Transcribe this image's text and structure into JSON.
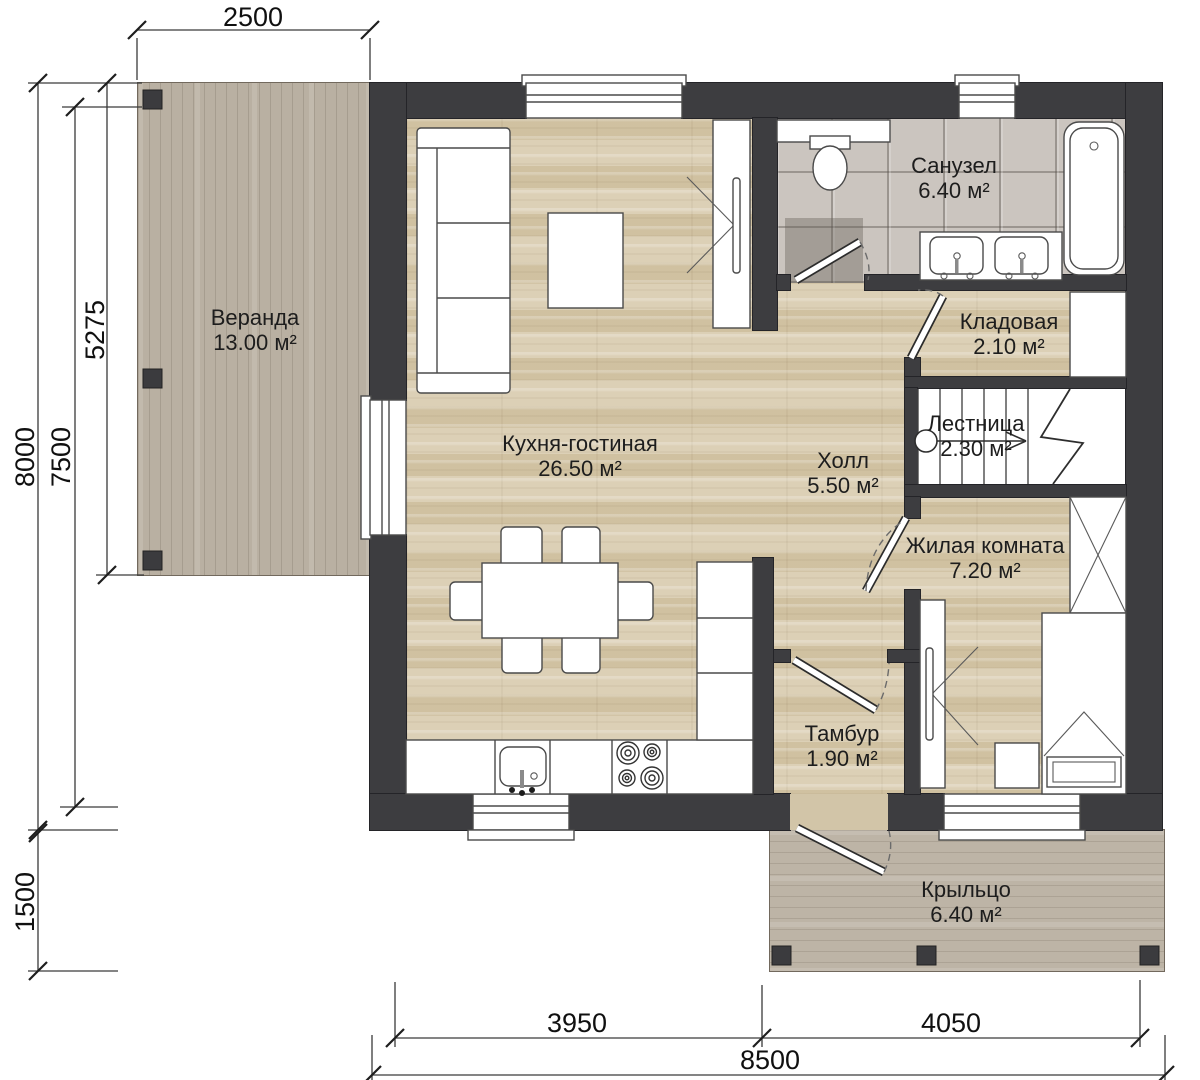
{
  "plan": {
    "title": "Floor plan — first floor",
    "rooms": [
      {
        "id": "veranda",
        "name": "Веранда",
        "area": "13.00 м²"
      },
      {
        "id": "kitchen",
        "name": "Кухня-гостиная",
        "area": "26.50 м²"
      },
      {
        "id": "bathroom",
        "name": "Санузел",
        "area": "6.40 м²"
      },
      {
        "id": "storage",
        "name": "Кладовая",
        "area": "2.10 м²"
      },
      {
        "id": "stairs",
        "name": "Лестница",
        "area": "2.30 м²"
      },
      {
        "id": "hall",
        "name": "Холл",
        "area": "5.50 м²"
      },
      {
        "id": "bedroom",
        "name": "Жилая комната",
        "area": "7.20 м²"
      },
      {
        "id": "tambour",
        "name": "Тамбур",
        "area": "1.90 м²"
      },
      {
        "id": "porch",
        "name": "Крыльцо",
        "area": "6.40 м²"
      }
    ],
    "dimensions": {
      "top": "2500",
      "left_outer": "8000",
      "left_mid": "7500",
      "left_inner": "5275",
      "left_bottom": "1500",
      "bottom_left": "3950",
      "bottom_right": "4050",
      "bottom_total": "8500"
    },
    "colors": {
      "wall": "#3d3d40",
      "wood_floor": "#d7caac",
      "deck": "#b9b0a2",
      "tile": "#cbc5bf",
      "fixture": "#ffffff"
    }
  }
}
